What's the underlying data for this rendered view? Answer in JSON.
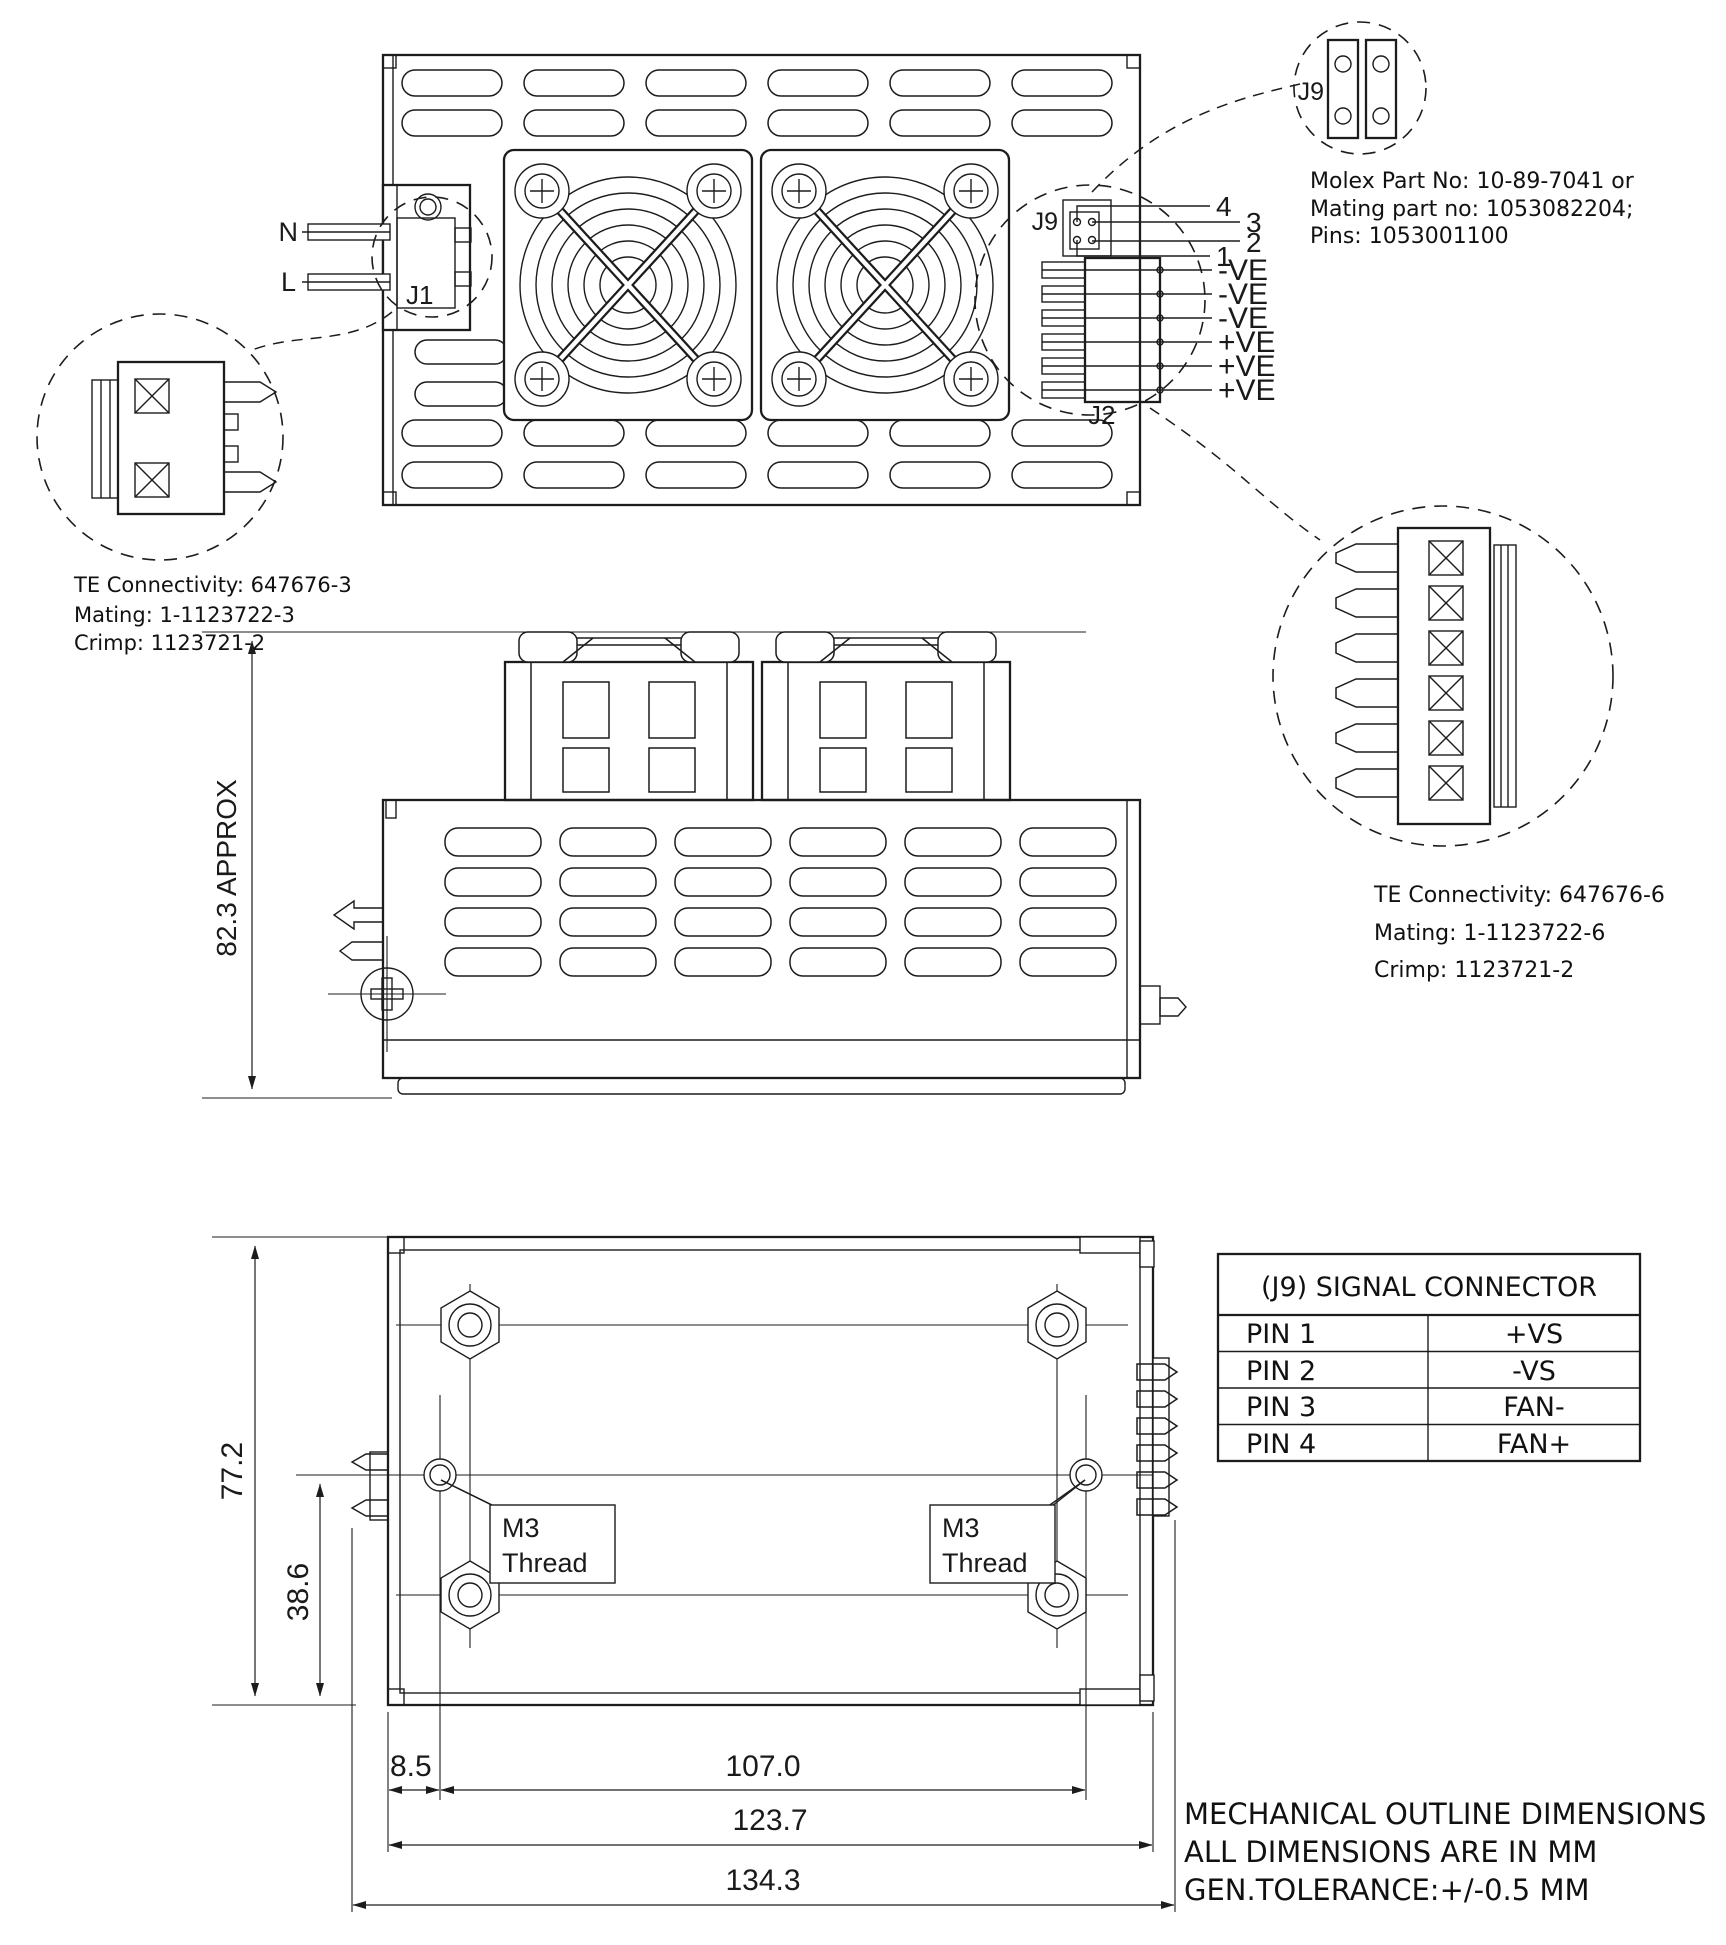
{
  "colors": {
    "line": "#1c1c1c",
    "bg": "#ffffff",
    "text": "#111111"
  },
  "top_view": {
    "neutral_label": "N",
    "line_label": "L",
    "j1_label": "J1",
    "j9_label": "J9",
    "j2_label": "J2",
    "signal_pins": [
      "4",
      "3",
      "2",
      "1"
    ],
    "output_pins": [
      "-VE",
      "-VE",
      "-VE",
      "+VE",
      "+VE",
      "+VE"
    ]
  },
  "j9_detail": {
    "label": "J9",
    "lines": [
      "Molex Part No: 10-89-7041 or",
      "Mating part no: 1053082204;",
      "Pins: 1053001100"
    ]
  },
  "j1_detail": {
    "lines": [
      "TE Connectivity: 647676-3",
      "Mating: 1-1123722-3",
      "Crimp: 1123721-2"
    ]
  },
  "j2_detail": {
    "lines": [
      "TE Connectivity: 647676-6",
      "Mating: 1-1123722-6",
      "Crimp: 1123721-2"
    ]
  },
  "front_view": {
    "height_dim": "82.3 APPROX"
  },
  "bottom_view": {
    "overall_height": "77.2",
    "hole_to_edge": "38.6",
    "edge_to_hole": "8.5",
    "hole_spacing": "107.0",
    "body_width": "123.7",
    "overall_width": "134.3",
    "m3_line1": "M3",
    "m3_line2": "Thread"
  },
  "signal_table": {
    "title": "(J9) SIGNAL CONNECTOR",
    "rows": [
      {
        "pin": "PIN 1",
        "signal": "+VS"
      },
      {
        "pin": "PIN 2",
        "signal": "-VS"
      },
      {
        "pin": "PIN 3",
        "signal": "FAN-"
      },
      {
        "pin": "PIN 4",
        "signal": "FAN+"
      }
    ]
  },
  "notes": [
    "MECHANICAL OUTLINE DIMENSIONS",
    "ALL DIMENSIONS ARE IN MM",
    "GEN.TOLERANCE:+/-0.5 MM"
  ]
}
